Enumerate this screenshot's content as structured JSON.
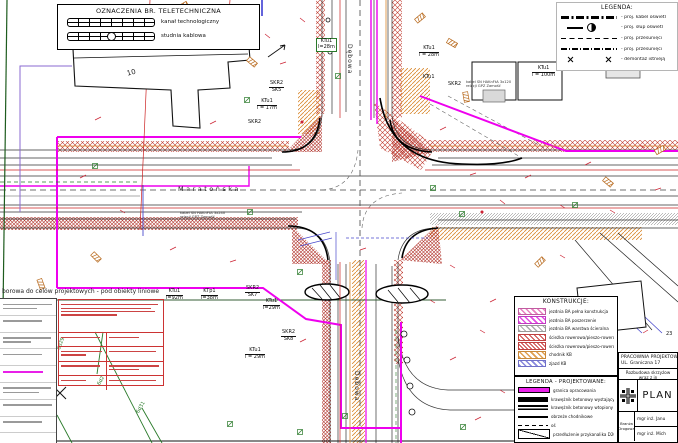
{
  "note": {
    "map_basis": "borowa do celów projektowych - pod obiekty liniowe"
  },
  "teletech_legend": {
    "title": "OZNACZENIA BR. TELETECHNICZNA",
    "items": [
      {
        "symbol": "kanal",
        "label": "kanał technologiczny"
      },
      {
        "symbol": "studnia",
        "label": "studnia kablowa"
      }
    ]
  },
  "legend": {
    "title": "LEGENDA:",
    "items": [
      {
        "symbol": "dashdot-bold",
        "label": "- proj. kabel oświetl"
      },
      {
        "symbol": "lamp",
        "label": "- proj. słup oświetl"
      },
      {
        "symbol": "dashed",
        "label": "- proj. przesunięci"
      },
      {
        "symbol": "dashdot",
        "label": "- proj. przesunięci"
      },
      {
        "symbol": "xx",
        "label": "- demontaż istnieją"
      }
    ]
  },
  "konstrukcje_legend": {
    "title": "KONSTRUKCJE:",
    "items": [
      {
        "swatch": "pink",
        "label": "jezdnia BA pełna konstrukcja"
      },
      {
        "swatch": "magenta",
        "label": "jezdnia BA poszerzenie"
      },
      {
        "swatch": "gray",
        "label": "jezdnia BA warstwa ścieralna"
      },
      {
        "swatch": "red",
        "label": "ścieżka rowerowa/pieszo-rowerowa BA"
      },
      {
        "swatch": "red2",
        "label": "ścieżka rowerowa/pieszo-rowerowa KB"
      },
      {
        "swatch": "orange",
        "label": "chodnik KB"
      },
      {
        "swatch": "blue",
        "label": "zjazd KB"
      }
    ]
  },
  "projektowane_legend": {
    "title": "LEGENDA  -  PROJEKTOWANE:",
    "items": [
      {
        "symbol": "magenta-line",
        "label": "granica opracowania"
      },
      {
        "symbol": "thick-bar",
        "label": "krawężnik betonowy wystający"
      },
      {
        "symbol": "thick-bar2",
        "label": "krawężnik betonowy wtopiony"
      },
      {
        "symbol": "thin-bar",
        "label": "obrzeże chodnikowe"
      },
      {
        "symbol": "dash-line",
        "label": "oś"
      },
      {
        "symbol": "diag-box",
        "label": "przedłużenie przykanalika D200"
      }
    ]
  },
  "title_block": {
    "company_line1": "PRACOWNIA PROJEKTOW",
    "company_line2": "UL. Graniczna 17",
    "project_line1": "Rozbudowa skrzyżow",
    "project_line2": "wraz z in",
    "drawing_title": "PLAN",
    "branch_label": "Branża Drogowa",
    "designer1": "mgr inż. Janu",
    "designer2": "mgr inż. Mich"
  },
  "map": {
    "labels": [
      {
        "name": "label-ktu1-92",
        "lines": [
          "KTu1",
          "l=92m"
        ],
        "x": 166,
        "y": 289
      },
      {
        "name": "label-ktp1-38",
        "lines": [
          "KTp1",
          "l=38m"
        ],
        "x": 201,
        "y": 289
      },
      {
        "name": "label-skr2-sk7",
        "lines": [
          "SKR2",
          "SK7"
        ],
        "x": 245,
        "y": 286
      },
      {
        "name": "label-ktu1-29",
        "lines": [
          "KTu1",
          "l=29m"
        ],
        "x": 263,
        "y": 299
      },
      {
        "name": "label-skr2-sk8",
        "lines": [
          "SKR2",
          "SK8"
        ],
        "x": 281,
        "y": 330
      },
      {
        "name": "label-skr2-sk5",
        "lines": [
          "SKR2",
          "SK5"
        ],
        "x": 269,
        "y": 81
      },
      {
        "name": "label-ktu1-17",
        "lines": [
          "KTu1",
          "l = 17m"
        ],
        "x": 257,
        "y": 99
      },
      {
        "name": "label-skr2",
        "lines": [
          "SKR2"
        ],
        "x": 248,
        "y": 120
      },
      {
        "name": "label-ktu1-28-r",
        "lines": [
          "KTu1",
          "l = 28m"
        ],
        "x": 419,
        "y": 46
      },
      {
        "name": "label-ktu1-28-g",
        "lines": [
          "KTu1",
          "l=28m"
        ],
        "x": 316,
        "y": 38,
        "cls": "greenbox"
      },
      {
        "name": "label-ktu1-100",
        "lines": [
          "KTu1",
          "l = 100m"
        ],
        "x": 532,
        "y": 66
      },
      {
        "name": "label-skr2-b",
        "lines": [
          "SKR2"
        ],
        "x": 448,
        "y": 82
      },
      {
        "name": "label-ktu1-c",
        "lines": [
          "KTu1"
        ],
        "x": 423,
        "y": 75
      },
      {
        "name": "label-ktu1-29b",
        "lines": [
          "KTu1",
          "l = 29m"
        ],
        "x": 245,
        "y": 348
      },
      {
        "name": "street-maratonska",
        "lines": [
          "Maratońska"
        ],
        "x": 178,
        "y": 186,
        "cls": "street"
      },
      {
        "name": "street-debowa-north",
        "lines": [
          "Dębowa"
        ],
        "x": 352,
        "y": 44,
        "rot": 90,
        "cls": "streetv"
      },
      {
        "name": "street-debowa-south",
        "lines": [
          "Dębowa"
        ],
        "x": 359,
        "y": 371,
        "rot": 90,
        "cls": "streetv"
      },
      {
        "name": "label-6d1",
        "lines": [
          "6d1"
        ],
        "x": 45,
        "y": 424,
        "rot": -60,
        "cls": "green"
      },
      {
        "name": "label-6d2",
        "lines": [
          "6d2"
        ],
        "x": 97,
        "y": 384,
        "rot": -60,
        "cls": "green"
      },
      {
        "name": "label-6d29",
        "lines": [
          "6d29"
        ],
        "x": 57,
        "y": 349,
        "rot": -70,
        "cls": "green"
      },
      {
        "name": "label-6d31",
        "lines": [
          "6d31"
        ],
        "x": 136,
        "y": 412,
        "rot": -60,
        "cls": "green"
      },
      {
        "name": "label-cable-west",
        "lines": [
          "kabel SN HAKnFtA 3x240",
          "relacji GPZ Zamość"
        ],
        "x": 180,
        "y": 211,
        "cls": "tiny"
      },
      {
        "name": "label-cable-east",
        "lines": [
          "kabel SN HAKnFtA 3x120",
          "relacji GPZ Zamość"
        ],
        "x": 466,
        "y": 80,
        "cls": "tiny"
      },
      {
        "name": "label-building-10",
        "lines": [
          "10"
        ],
        "x": 126,
        "y": 70,
        "rot": -15,
        "cls": "bld"
      },
      {
        "name": "label-23",
        "lines": [
          "23"
        ],
        "x": 666,
        "y": 332,
        "cls": "tiny2"
      }
    ]
  },
  "colors": {
    "boundary_magenta": "#ee00ee",
    "hatch_red": "#c0392b",
    "hatch_orange": "#d9882e",
    "utility_green": "#2a7a2a",
    "utility_blue": "#4a4acc",
    "utility_red": "#cc2222"
  }
}
